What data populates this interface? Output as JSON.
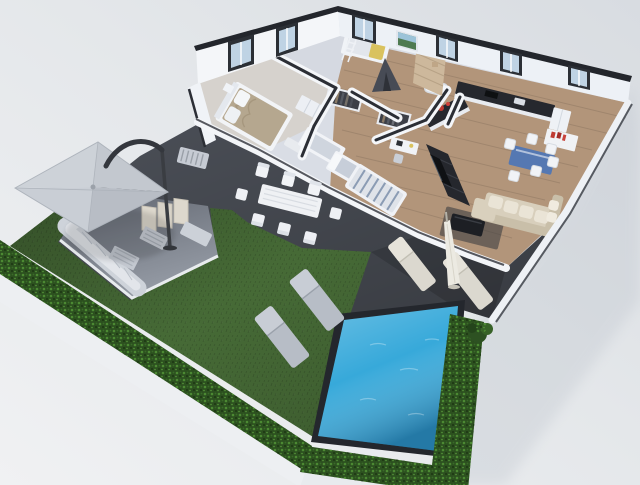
{
  "meta": {
    "description": "3D isometric floor-plan rendering of an apartment with garden, dark terrace and swimming pool",
    "image_type": "architectural 3D render",
    "visible_text": "none"
  },
  "palette": {
    "backdrop_light": "#f0f1f3",
    "backdrop_dark": "#d8dce1",
    "terrace": "#4b4f57",
    "terrace_shade": "#3e424a",
    "lawn": "#4a7039",
    "hedge": "#2c501f",
    "hedge_leaf": "#4c8a33",
    "pool_water": "#37a9da",
    "pool_coping": "#24272d",
    "wall_face": "#f4f6f9",
    "wall_shaded": "#edf1f6",
    "wall_top": "#23262c",
    "floor_base": "#d9dde5",
    "floor_bedroom": "#d6d2cd",
    "floor_wood": "#b2957a",
    "glass": "#bfd3e4",
    "stone_wall": "#cdb89c",
    "kitchen_counter": "#26282e",
    "sofa": "#d8cfbc",
    "cushion": "#eae4d6",
    "media_wall": "#25272d",
    "tv": "#0f1114",
    "table_glass": "#5578b2",
    "outdoor_white": "#eff1f4",
    "outdoor_grey": "#ced3da",
    "lounger_grey": "#b7bdc6",
    "lounger_beige": "#dbd8cf",
    "umbrella": "#ccd0d7",
    "umbrella_arm": "#34373d",
    "bed_duvet": "#b5a78f",
    "stripe": "#8b9cb4",
    "accent_red": "#bf3a31",
    "accent_yellow": "#d9c25e",
    "bush": "#2d5122"
  },
  "scene": {
    "areas": [
      {
        "id": "garden",
        "label": "lawn bordered by boxwood hedge"
      },
      {
        "id": "pool",
        "label": "blue swimming pool with dark coping"
      },
      {
        "id": "terrace",
        "label": "dark grey terrace and pool deck"
      },
      {
        "id": "master-bedroom",
        "label": "double bed, bench, wardrobe"
      },
      {
        "id": "kids-bedroom",
        "label": "bunk bed with ladder, teepee tent, wall art"
      },
      {
        "id": "bedroom-study",
        "label": "two single beds, striped day bed, desk, open wardrobes"
      },
      {
        "id": "bathroom",
        "label": "stone accent wall"
      },
      {
        "id": "kitchen",
        "label": "dark L-counter with island, red pot, wall shelf, sideboard"
      },
      {
        "id": "living-dining",
        "label": "beige corner sofa, TV media wall, blue glass dining table with white chairs"
      }
    ],
    "outdoor_objects": [
      "grey cantilever parasol",
      "L-shaped outdoor lounge set",
      "two slatted coffee tables",
      "outdoor dining table with eight white chairs",
      "privacy screen panels",
      "radiator bench",
      "two grey sun loungers on lawn",
      "two beige loungers on pool deck",
      "closed white parasol",
      "boxwood bush"
    ]
  }
}
